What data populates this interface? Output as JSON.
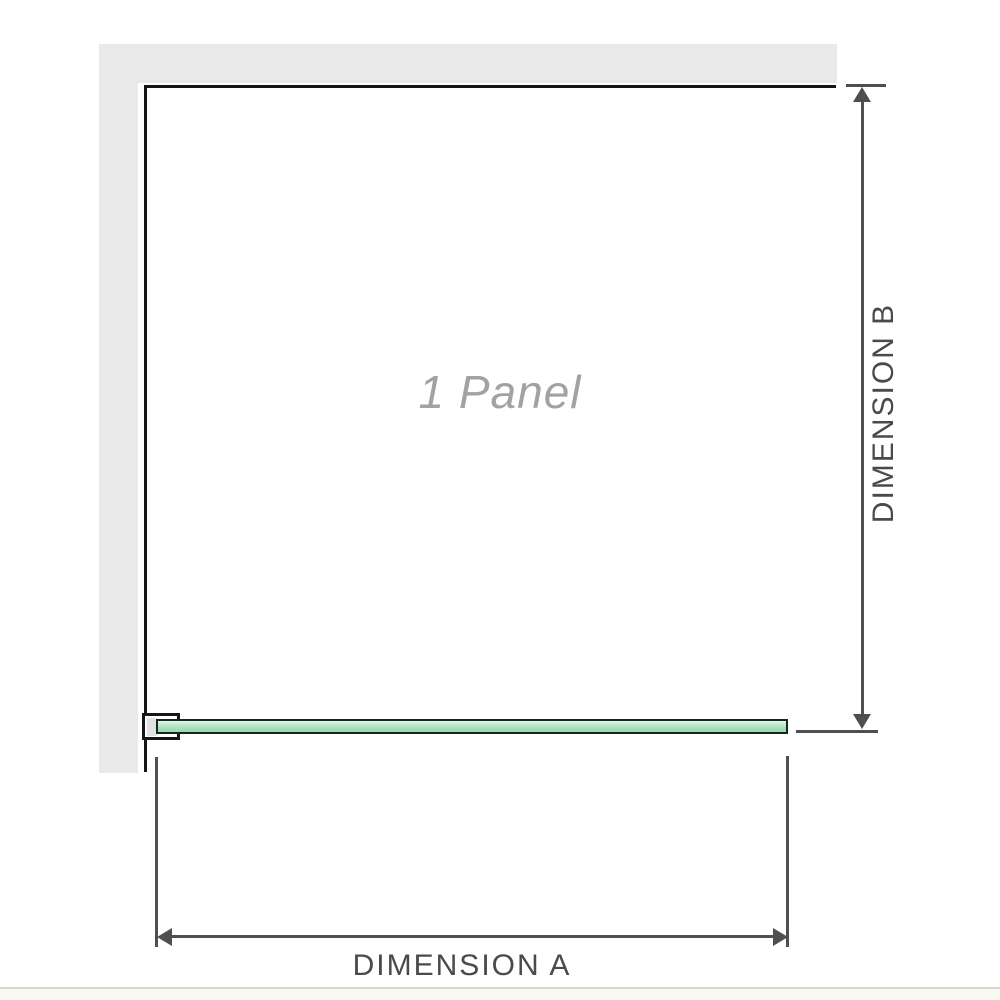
{
  "diagram": {
    "panel_label": "1 Panel",
    "dimension_a_label": "DIMENSION A",
    "dimension_b_label": "DIMENSION B",
    "colors": {
      "wall": "#e9e9e9",
      "outline": "#161616",
      "dimension_line": "#4f4f4f",
      "dimension_text": "#4a4a4a",
      "panel_text": "#a2a2a2",
      "glass_border": "#13291d",
      "glass_light": "#e8f6ec",
      "glass_dark": "#9bd8b2",
      "footer_line": "#d9d6d1",
      "footer_bg": "#faf8f2"
    }
  }
}
